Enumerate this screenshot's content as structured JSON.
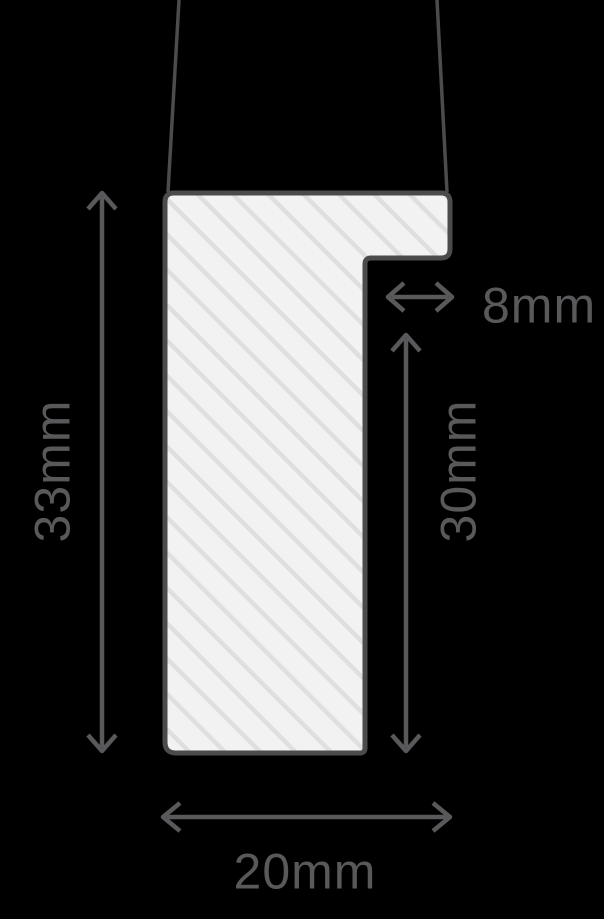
{
  "colors": {
    "background": "#000000",
    "leader": "#4c4c4e",
    "profile_outline": "#4b4b4d",
    "profile_fill": "#f2f2f2",
    "hatch_stripe": "#dfdfdf",
    "dimension": "#59595b"
  },
  "dimensions": {
    "left_height": "33mm",
    "rebate_width": "8mm",
    "right_height": "30mm",
    "bottom_width": "20mm"
  }
}
